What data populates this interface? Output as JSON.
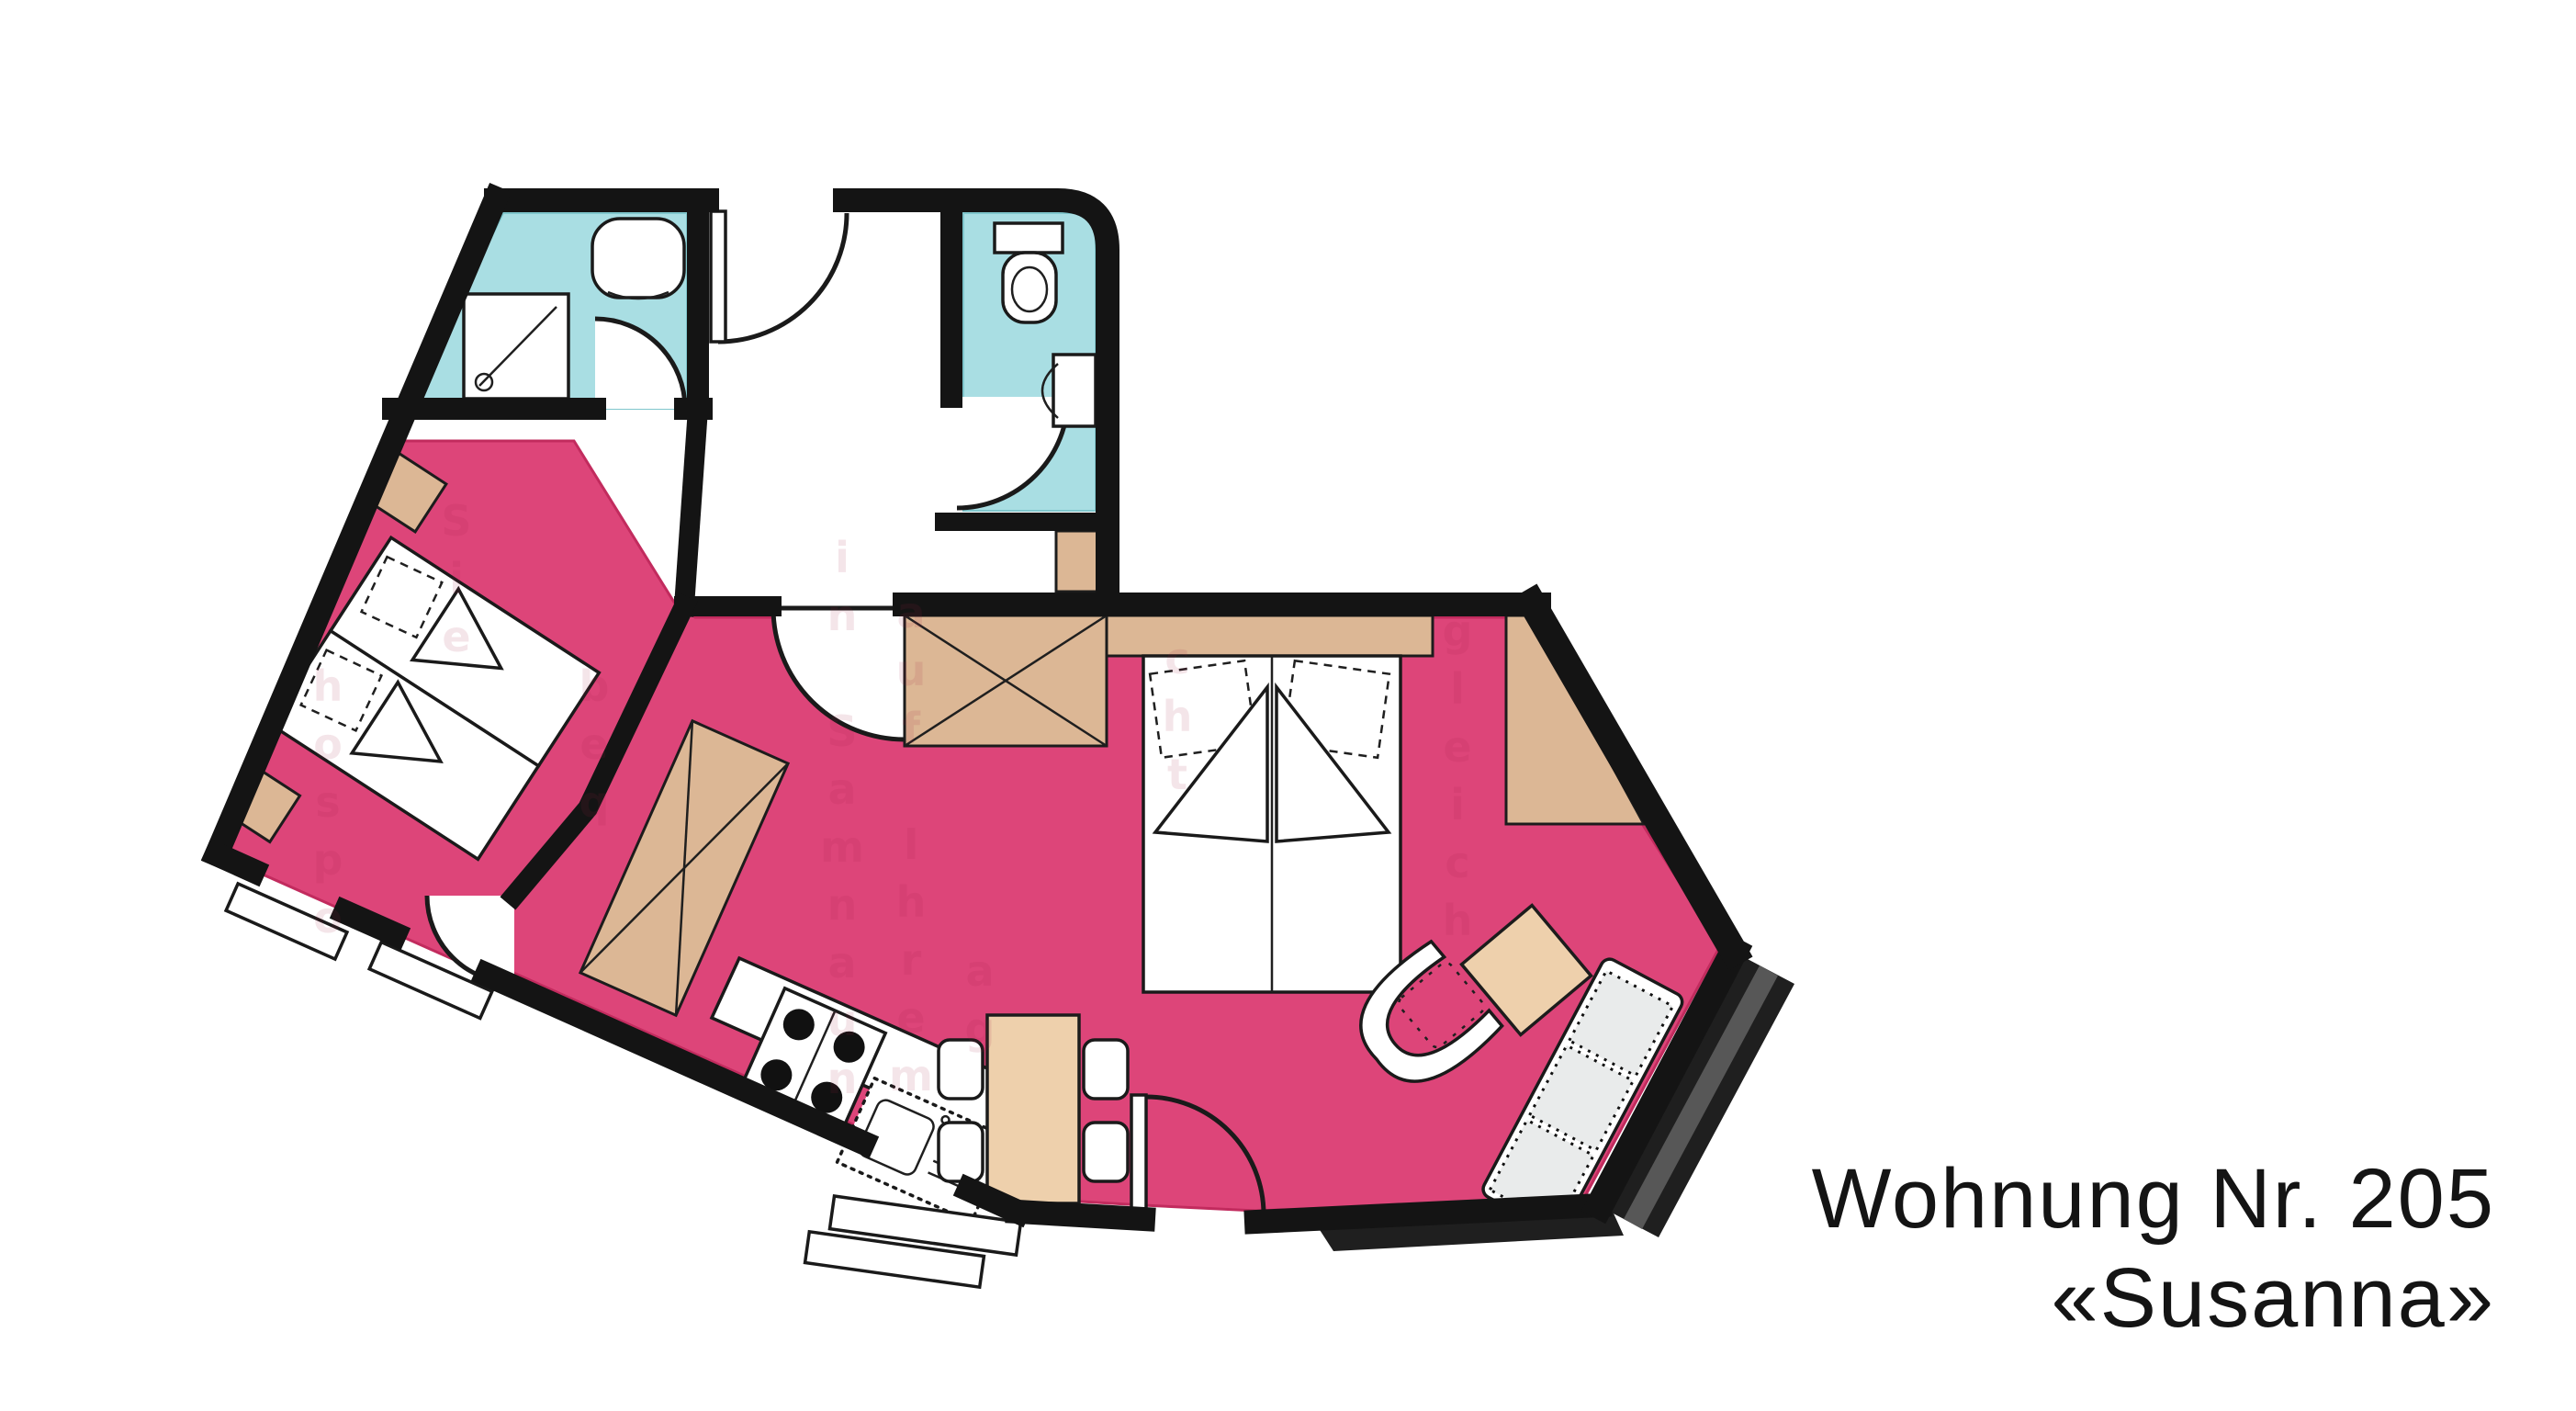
{
  "title": {
    "line1": "Wohnung Nr. 205",
    "line2": "«Susanna»"
  },
  "apartment": {
    "number": "205",
    "name": "Susanna"
  },
  "watermark": {
    "fragments": [
      "gleich",
      "in Samnaun",
      "auf Ihrem",
      "hospo",
      "beq",
      "cht",
      "Sie",
      "ag"
    ]
  },
  "colors": {
    "pink": "#dd4579",
    "cyan": "#a9dee3",
    "tan": "#dcb795",
    "tan-light": "#eed0ac",
    "wall": "#141414",
    "cushion": "#e9ebeb",
    "balcony-dark": "#1f1f1f",
    "balcony-mid": "#575757",
    "watermark-ink": "#a51d45",
    "title-ink": "#141414"
  }
}
